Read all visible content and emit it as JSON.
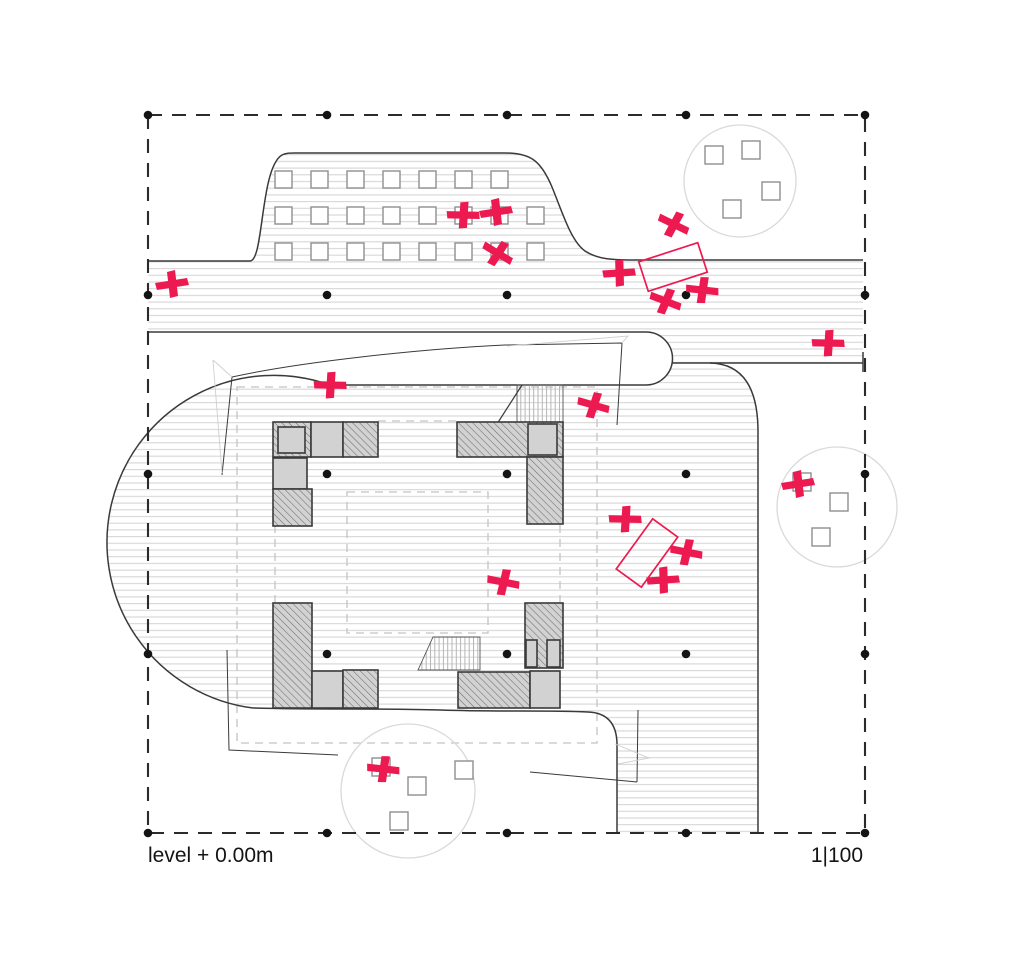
{
  "labels": {
    "level": "level + 0.00m",
    "scale": "1|100"
  },
  "colors": {
    "accent_pink": "#ec1a50",
    "line_dark": "#3a3a3a",
    "wall_grey": "#d2d2d2",
    "wall_hatch_line": "#6e6e6e",
    "ground_hatch_line": "#d6d6d6",
    "stair_hatch_line": "#b5b5b5",
    "dashed_grey": "#c4c4c4",
    "tree_grey": "#d9d9d9",
    "square_grey": "#8f8f8f",
    "dot_black": "#141414",
    "border_dark": "#2b2b2b"
  },
  "border": {
    "x": 148,
    "y": 115,
    "w": 717,
    "h": 718,
    "dash": "14 10"
  },
  "grid_dots": {
    "xs": [
      148,
      327,
      507,
      686,
      865
    ],
    "ys": [
      115,
      295,
      474,
      654,
      833
    ],
    "r": 4.3
  },
  "bump_plaza": {
    "square_size": 17,
    "rows": [
      {
        "y": 171,
        "xs": [
          275,
          311,
          347,
          383,
          419,
          455,
          491
        ]
      },
      {
        "y": 207,
        "xs": [
          275,
          311,
          347,
          383,
          419,
          455,
          491,
          527
        ]
      },
      {
        "y": 243,
        "xs": [
          275,
          311,
          347,
          383,
          419,
          455,
          491,
          527
        ]
      }
    ]
  },
  "trees": [
    {
      "cx": 740,
      "cy": 181,
      "r": 56,
      "squares": [
        [
          705,
          146
        ],
        [
          742,
          141
        ],
        [
          762,
          182
        ],
        [
          723,
          200
        ]
      ]
    },
    {
      "cx": 837,
      "cy": 507,
      "r": 60,
      "squares": [
        [
          793,
          473
        ],
        [
          830,
          493
        ],
        [
          812,
          528
        ]
      ]
    },
    {
      "cx": 408,
      "cy": 791,
      "r": 67,
      "squares": [
        [
          372,
          758
        ],
        [
          408,
          777
        ],
        [
          455,
          761
        ],
        [
          390,
          812
        ]
      ]
    }
  ],
  "tree_square_size": 18,
  "tables": [
    {
      "cx": 673,
      "cy": 267,
      "w": 62,
      "h": 31,
      "rot": -18
    },
    {
      "cx": 647,
      "cy": 553,
      "w": 31,
      "h": 62,
      "rot": 36
    }
  ],
  "people": [
    [
      172,
      285,
      0
    ],
    [
      463,
      216,
      10
    ],
    [
      496,
      213,
      0
    ],
    [
      497,
      254,
      40
    ],
    [
      673,
      225,
      35
    ],
    [
      619,
      274,
      5
    ],
    [
      665,
      302,
      30
    ],
    [
      702,
      291,
      15
    ],
    [
      828,
      344,
      10
    ],
    [
      330,
      386,
      10
    ],
    [
      593,
      406,
      25
    ],
    [
      625,
      520,
      10
    ],
    [
      686,
      553,
      20
    ],
    [
      663,
      581,
      5
    ],
    [
      503,
      583,
      20
    ],
    [
      798,
      485,
      0
    ],
    [
      383,
      770,
      15
    ]
  ],
  "walls": [
    [
      273,
      422,
      38,
      35,
      "h"
    ],
    [
      278,
      427,
      27,
      26,
      "g"
    ],
    [
      311,
      422,
      32,
      35,
      "g"
    ],
    [
      343,
      422,
      35,
      35,
      "h"
    ],
    [
      273,
      458,
      34,
      31,
      "g"
    ],
    [
      273,
      489,
      39,
      37,
      "h"
    ],
    [
      457,
      422,
      106,
      35,
      "h"
    ],
    [
      528,
      424,
      29,
      31,
      "g"
    ],
    [
      527,
      457,
      36,
      67,
      "h"
    ],
    [
      273,
      603,
      39,
      105,
      "h"
    ],
    [
      312,
      671,
      31,
      37,
      "g"
    ],
    [
      343,
      670,
      35,
      38,
      "h"
    ],
    [
      525,
      603,
      38,
      65,
      "h"
    ],
    [
      526,
      640,
      11,
      27,
      "g"
    ],
    [
      547,
      640,
      13,
      27,
      "g"
    ],
    [
      458,
      672,
      72,
      36,
      "h"
    ],
    [
      530,
      671,
      30,
      37,
      "g"
    ]
  ],
  "stairs": {
    "top_rect": [
      517,
      385,
      46,
      38
    ],
    "top_diag": "M497,424 L522,385",
    "bottom_path": "M433,637 L480,637 L480,670 L418,670 Z"
  },
  "geometry": {
    "ground_fill": "M148,261 L250,261 C264,261 260,168 282,155 C286,153 290,153 295,153 L505,153 C531,153 541,161 552,187 C563,214 571,241 585,251 C597,259 612,260 632,260 L863,260 L863,363 L710,363 Q757,364 758,429 L758,833 L617,833 L617,743 Q616,713 588,712 L253,708 A167,167 0 1 1 330,385 L148,385 Z",
    "band_fill": "M148,332 L646,332 A26.5,26.5 0 0 1 646,385 L148,385 Z",
    "band_stroke": "M148,332 L646,332 A26.5,26.5 0 0 1 646,385 L330,385",
    "bump_stroke": "M148,261 L250,261 C264,261 260,168 282,155 C286,153 290,153 295,153 L505,153 C531,153 541,161 552,187 C563,214 571,241 585,251 C597,259 612,260 632,260 L863,260",
    "road_top": "M672,363 L863,363 M863,352 L863,372",
    "road_corner": "M710,363 Q757,364 758,429 L758,833",
    "ground_bottom": "M253,708 C320,710 380,708 440,710 C500,712 545,710 588,712 Q616,713 617,743 L617,833",
    "left_arc": "M253,708 A167,167 0 1 1 330,385",
    "sketch_dark": "M232,377 C300,362 420,349 505,345 L622,343 L617,425 M232,377 L222,475 M227,650 L229,750 L338,755 M530,772 L637,782 M638,710 L637,782",
    "sketch_light": "M213,360 L232,377 M213,360 L222,473 M507,346 L628,336 L622,343 M615,744 L649,758 L618,764",
    "roof_dashed": "M237,387 L597,387 L597,743 L237,743 Z",
    "courtyard_dashed": "M347,492 L488,492 L488,633 L347,633 Z",
    "facade_dashed": "M378,421 L457,421 M275,525 L275,603 M560,525 L560,603"
  }
}
